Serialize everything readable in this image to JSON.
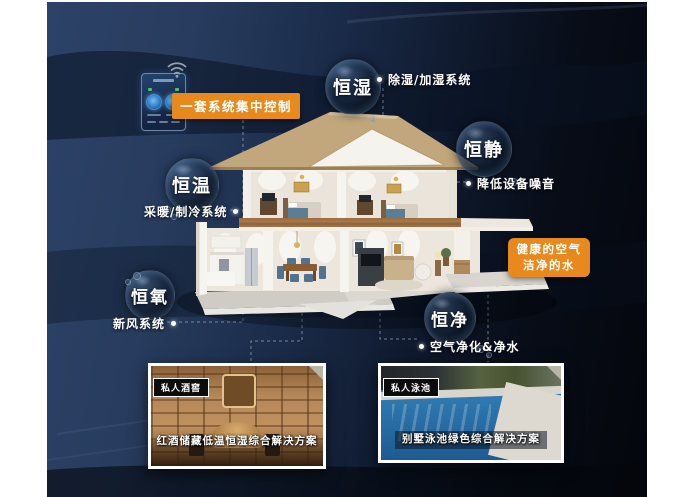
{
  "control_panel": {
    "label": "一套系统集中控制",
    "device_icon": "smart-control-panel",
    "wifi_icon": "wifi-signal"
  },
  "bubbles": [
    {
      "key": "humidity",
      "label": "恒湿",
      "desc": "除湿/加湿系统"
    },
    {
      "key": "quiet",
      "label": "恒静",
      "desc": "降低设备噪音"
    },
    {
      "key": "temperature",
      "label": "恒温",
      "desc": "采暖/制冷系统"
    },
    {
      "key": "oxygen",
      "label": "恒氧",
      "desc": "新风系统"
    },
    {
      "key": "purity",
      "label": "恒净",
      "desc": "空气净化&净水"
    }
  ],
  "highlight": {
    "line1": "健康的空气",
    "line2": "洁净的水"
  },
  "photos": [
    {
      "tag": "私人酒窖",
      "caption": "红酒储藏低温恒湿综合解决方案"
    },
    {
      "tag": "私人泳池",
      "caption": "别墅泳池绿色综合解决方案"
    }
  ],
  "colors": {
    "accent_orange": "#e8891d",
    "background_navy": "#22365a",
    "background_dark": "#05070d"
  }
}
